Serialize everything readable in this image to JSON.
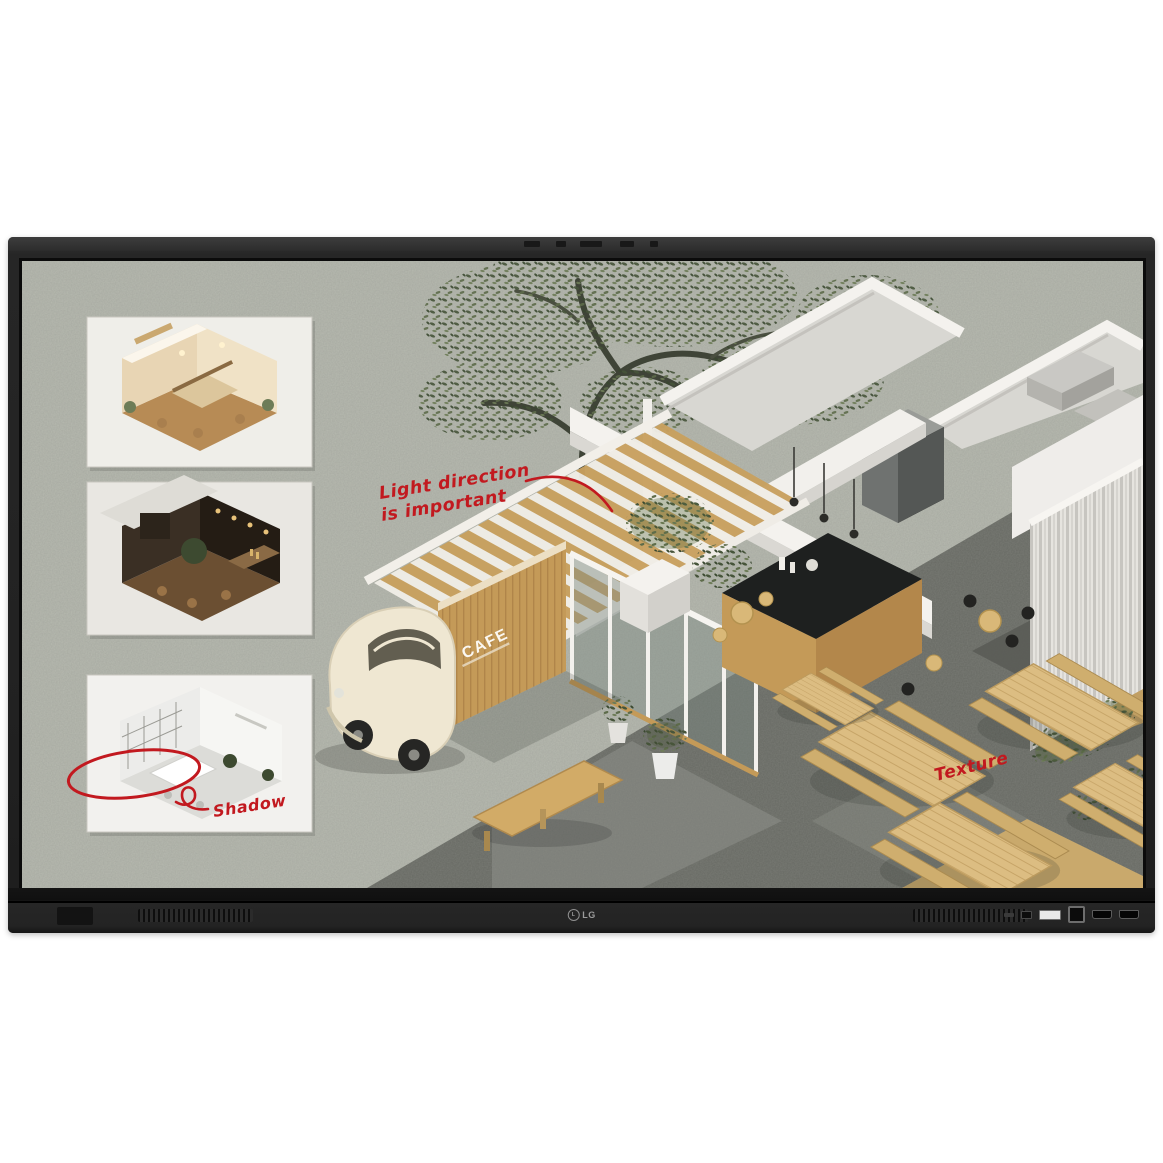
{
  "device": {
    "brand_logo": "LG",
    "type_label": "interactive display"
  },
  "screen_content": {
    "annotations": {
      "light_direction_line1": "Light direction",
      "light_direction_line2": "is important",
      "texture": "Texture",
      "shadow": "Shadow"
    },
    "cafe_sign": "CAFE",
    "colors": {
      "annotation_red": "#c2191f",
      "gravel": "#b7bab0",
      "dark_paving": "#676963",
      "wood": "#c49a58",
      "light_wood": "#dcbd82",
      "wall_white": "#f3f1ed",
      "foliage_green": "#4c5a3c",
      "counter_black": "#1e201f",
      "car_cream": "#efe7d2",
      "bezel": "#222222"
    }
  }
}
